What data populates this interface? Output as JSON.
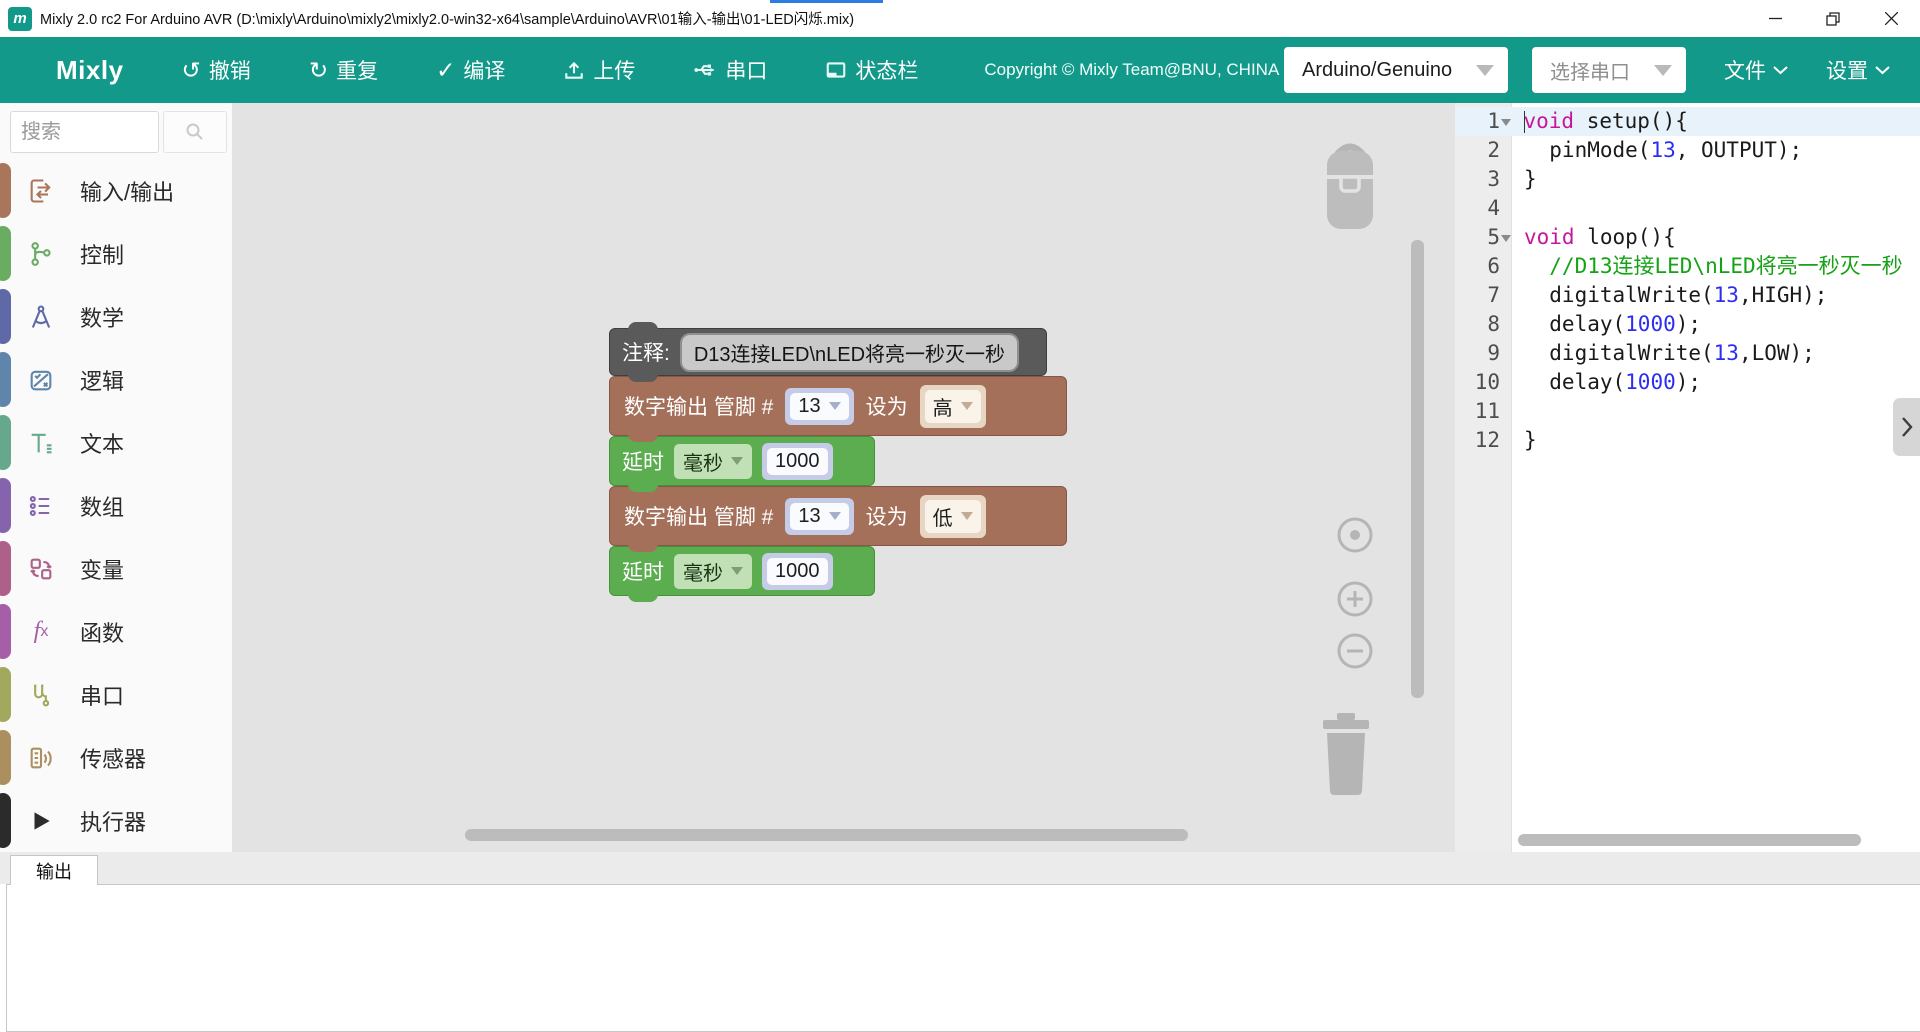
{
  "window": {
    "title": "Mixly 2.0 rc2 For Arduino AVR (D:\\mixly\\Arduino\\mixly2\\mixly2.0-win32-x64\\sample\\Arduino\\AVR\\01输入-输出\\01-LED闪烁.mix)",
    "app_icon_letter": "m"
  },
  "toolbar": {
    "brand": "Mixly",
    "buttons": [
      {
        "label": "撤销",
        "icon": "undo-icon"
      },
      {
        "label": "重复",
        "icon": "redo-icon"
      },
      {
        "label": "编译",
        "icon": "compile-check-icon"
      },
      {
        "label": "上传",
        "icon": "upload-icon"
      },
      {
        "label": "串口",
        "icon": "serial-monitor-icon"
      },
      {
        "label": "状态栏",
        "icon": "statusbar-icon"
      }
    ],
    "copyright": "Copyright © Mixly Team@BNU, CHINA",
    "board_select": {
      "value": "Arduino/Genuino"
    },
    "port_select": {
      "placeholder": "选择串口"
    },
    "menus": [
      {
        "label": "文件"
      },
      {
        "label": "设置"
      }
    ]
  },
  "sidebar": {
    "search_placeholder": "搜索",
    "categories": [
      {
        "label": "输入/输出",
        "color": "#a9765c",
        "icon": "input-output-icon"
      },
      {
        "label": "控制",
        "color": "#6aac62",
        "icon": "control-icon"
      },
      {
        "label": "数学",
        "color": "#6069a8",
        "icon": "math-icon"
      },
      {
        "label": "逻辑",
        "color": "#5f85ab",
        "icon": "logic-icon"
      },
      {
        "label": "文本",
        "color": "#65a88c",
        "icon": "text-icon"
      },
      {
        "label": "数组",
        "color": "#8563ad",
        "icon": "array-icon"
      },
      {
        "label": "变量",
        "color": "#ad6088",
        "icon": "variable-icon"
      },
      {
        "label": "函数",
        "color": "#a45fa8",
        "icon": "function-icon"
      },
      {
        "label": "串口",
        "color": "#a3a85f",
        "icon": "serial-port-icon"
      },
      {
        "label": "传感器",
        "color": "#ab8f5f",
        "icon": "sensor-icon"
      },
      {
        "label": "执行器",
        "color": "#2b2b2b",
        "icon": "actuator-icon"
      }
    ]
  },
  "workspace": {
    "blocks": [
      {
        "type": "comment",
        "label": "注释:",
        "text": "D13连接LED\\nLED将亮一秒灭一秒"
      },
      {
        "type": "digital-write",
        "label": "数字输出 管脚 #",
        "pin": "13",
        "set_label": "设为",
        "level": "高"
      },
      {
        "type": "delay",
        "label": "延时",
        "unit": "毫秒",
        "value": "1000"
      },
      {
        "type": "digital-write",
        "label": "数字输出 管脚 #",
        "pin": "13",
        "set_label": "设为",
        "level": "低"
      },
      {
        "type": "delay",
        "label": "延时",
        "unit": "毫秒",
        "value": "1000"
      }
    ]
  },
  "code_panel": {
    "lines": [
      {
        "no": "1",
        "fold": true,
        "active": true,
        "segs": [
          {
            "c": "kw",
            "t": "void"
          },
          {
            "c": "p",
            "t": " setup(){"
          }
        ]
      },
      {
        "no": "2",
        "segs": [
          {
            "c": "p",
            "t": "  pinMode("
          },
          {
            "c": "num",
            "t": "13"
          },
          {
            "c": "p",
            "t": ", OUTPUT);"
          }
        ]
      },
      {
        "no": "3",
        "segs": [
          {
            "c": "p",
            "t": "}"
          }
        ]
      },
      {
        "no": "4",
        "segs": []
      },
      {
        "no": "5",
        "fold": true,
        "segs": [
          {
            "c": "kw",
            "t": "void"
          },
          {
            "c": "p",
            "t": " loop(){"
          }
        ]
      },
      {
        "no": "6",
        "segs": [
          {
            "c": "com",
            "t": "  //D13连接LED\\nLED将亮一秒灭一秒"
          }
        ]
      },
      {
        "no": "7",
        "segs": [
          {
            "c": "p",
            "t": "  digitalWrite("
          },
          {
            "c": "num",
            "t": "13"
          },
          {
            "c": "p",
            "t": ",HIGH);"
          }
        ]
      },
      {
        "no": "8",
        "segs": [
          {
            "c": "p",
            "t": "  delay("
          },
          {
            "c": "num",
            "t": "1000"
          },
          {
            "c": "p",
            "t": ");"
          }
        ]
      },
      {
        "no": "9",
        "segs": [
          {
            "c": "p",
            "t": "  digitalWrite("
          },
          {
            "c": "num",
            "t": "13"
          },
          {
            "c": "p",
            "t": ",LOW);"
          }
        ]
      },
      {
        "no": "10",
        "segs": [
          {
            "c": "p",
            "t": "  delay("
          },
          {
            "c": "num",
            "t": "1000"
          },
          {
            "c": "p",
            "t": ");"
          }
        ]
      },
      {
        "no": "11",
        "segs": []
      },
      {
        "no": "12",
        "segs": [
          {
            "c": "p",
            "t": "}"
          }
        ]
      }
    ]
  },
  "output": {
    "tab_label": "输出"
  },
  "colors": {
    "toolbar_teal": "#12998a",
    "canvas_bg": "#e3e3e3",
    "comment_block": "#5a5a5a",
    "io_block_brown": "#a5705a",
    "control_block_green": "#5cad50",
    "code_keyword": "#c6179b",
    "code_number": "#2d2df0",
    "code_comment": "#15a315"
  }
}
